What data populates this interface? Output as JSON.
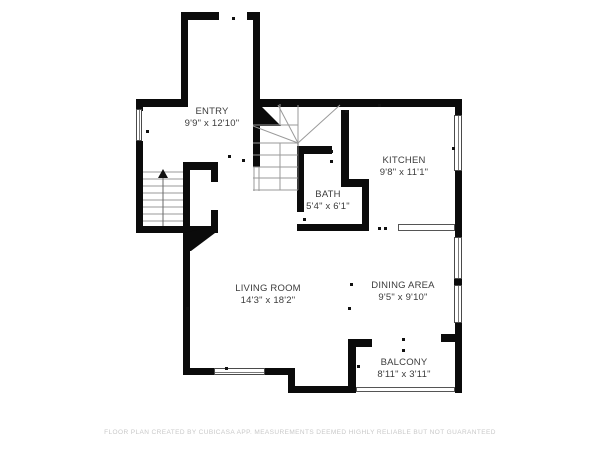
{
  "rooms": [
    {
      "id": "entry",
      "name": "ENTRY",
      "dims": "9'9\" x 12'10\""
    },
    {
      "id": "kitchen",
      "name": "KITCHEN",
      "dims": "9'8\" x 11'1\""
    },
    {
      "id": "bath",
      "name": "BATH",
      "dims": "5'4\" x 6'1\""
    },
    {
      "id": "living-room",
      "name": "LIVING ROOM",
      "dims": "14'3\" x 18'2\""
    },
    {
      "id": "dining-area",
      "name": "DINING AREA",
      "dims": "9'5\" x 9'10\""
    },
    {
      "id": "balcony",
      "name": "BALCONY",
      "dims": "8'11\" x 3'11\""
    }
  ],
  "footer": "FLOOR PLAN CREATED BY CUBICASA APP. MEASUREMENTS DEEMED HIGHLY RELIABLE BUT NOT GUARANTEED",
  "colors": {
    "wall": "#0b0b0b",
    "room_text": "#3c3c3c",
    "footer_text": "#c9c9c9",
    "stair_lines": "#9a9a9a",
    "background": "#ffffff"
  }
}
